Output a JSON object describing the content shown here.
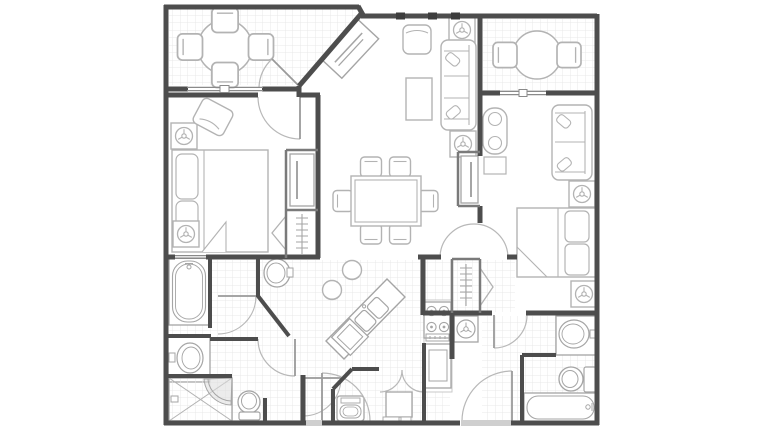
{
  "figure": {
    "type": "architectural-floor-plan",
    "label": "Two-bedroom resort villa floor plan, top-down view, no text labels",
    "background": "#ffffff"
  },
  "colors": {
    "wall": "#4d4d4d",
    "thin_wall": "#7a7a7a",
    "furniture_stroke": "#b3b3b3",
    "fixture_stroke": "#a5a5a5",
    "door_arc": "#b8b8b8",
    "tile_line": "#e9e9e9",
    "threshold": "#cfcfcf"
  },
  "rooms": {
    "balcony_left": {
      "label": "Top-left balcony with round patio table, four chairs, sliding glass door, tiled floor",
      "fixtures": [
        "patio-table-icon",
        "patio-chair-icon",
        "patio-chair-icon",
        "patio-chair-icon",
        "patio-chair-icon",
        "sliding-door-icon"
      ]
    },
    "balcony_right": {
      "label": "Top-right balcony with round patio table, two chairs, sliding glass door, tiled floor",
      "fixtures": [
        "patio-table-icon",
        "patio-chair-icon",
        "patio-chair-icon",
        "sliding-door-icon"
      ]
    },
    "living_room": {
      "label": "Living room with corner fireplace on angled wall, armchair, coffee table, sofa with throw pillows, two lamp end tables",
      "fixtures": [
        "fireplace-icon",
        "armchair-icon",
        "coffee-table-icon",
        "sofa-icon",
        "lamp-table-icon",
        "lamp-table-icon"
      ]
    },
    "dining_area": {
      "label": "Dining area with rectangular table and six chairs",
      "fixtures": [
        "dining-table-icon",
        "dining-chair-icon",
        "dining-chair-icon",
        "dining-chair-icon",
        "dining-chair-icon",
        "dining-chair-icon",
        "dining-chair-icon"
      ]
    },
    "kitchen": {
      "label": "Kitchen with angled island, double sink, two bar stools, dishwasher, four-burner range, refrigerator, water heater",
      "fixtures": [
        "island-counter-icon",
        "double-sink-icon",
        "bar-stool-icon",
        "bar-stool-icon",
        "dishwasher-icon",
        "range-icon",
        "refrigerator-icon",
        "water-heater-icon"
      ]
    },
    "bedroom_1": {
      "label": "Left bedroom with king bed, two pillows, two lamp end tables, accent chair, TV cabinet niche, closet with hanging rod",
      "fixtures": [
        "bed-icon",
        "pillow-icon",
        "pillow-icon",
        "lamp-table-icon",
        "lamp-table-icon",
        "accent-chair-icon",
        "tv-cabinet-icon",
        "closet-rod-icon"
      ]
    },
    "bedroom_2": {
      "label": "Right bedroom with king bed, loveseat, chaise chair with ottoman, two lamp tables, TV cabinet niche, closet with hanging rod, arched double-door entry",
      "fixtures": [
        "bed-icon",
        "loveseat-icon",
        "chaise-chair-icon",
        "ottoman-icon",
        "lamp-table-icon",
        "lamp-table-icon",
        "tv-cabinet-icon",
        "closet-rod-icon",
        "arched-door-icon"
      ]
    },
    "bathroom_1": {
      "label": "Master bathroom suite with soaking tub, vanity sink, pedestal sink, corner shower with glass door, toilet",
      "fixtures": [
        "bathtub-icon",
        "vanity-sink-icon",
        "pedestal-sink-icon",
        "shower-icon",
        "toilet-icon"
      ]
    },
    "bathroom_2": {
      "label": "Second bathroom with vanity sink, toilet, bathtub",
      "fixtures": [
        "vanity-sink-icon",
        "toilet-icon",
        "bathtub-icon"
      ]
    },
    "foyer": {
      "label": "Tiled entry foyer with two entry doors and interior doors",
      "fixtures": [
        "entry-door-icon",
        "entry-door-icon",
        "interior-door-icon"
      ]
    },
    "utility_closet": {
      "label": "Utility and laundry closet with bifold doors, washer, utility unit",
      "fixtures": [
        "bifold-door-icon",
        "washer-icon",
        "utility-unit-icon"
      ]
    }
  }
}
